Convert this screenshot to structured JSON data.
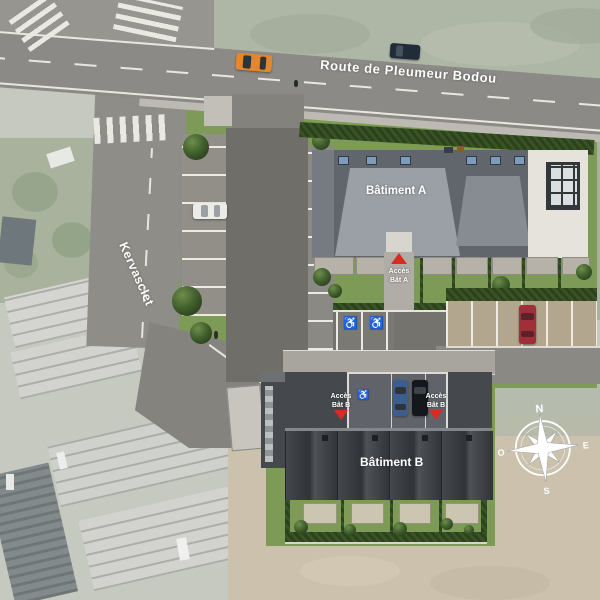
{
  "labels": {
    "route": "Route de Pleumeur Bodou",
    "street": "Kervasclet",
    "building_a": "Bâtiment A",
    "building_b": "Bâtiment B"
  },
  "access": {
    "a": {
      "line1": "Accès",
      "line2": "Bât A"
    },
    "b1": {
      "line1": "Accès",
      "line2": "Bât B"
    },
    "b2": {
      "line1": "Accès",
      "line2": "Bât B"
    }
  },
  "compass": {
    "north": "N",
    "east": "E",
    "south": "S",
    "west": "O"
  },
  "icons": {
    "accessible_parking": "♿"
  },
  "colors": {
    "road": "#8b8a86",
    "site_asphalt": "#6f6e69",
    "marking_white": "#eceae3",
    "grass": "#7d9b56",
    "hedge": "#33491f",
    "roof_a_dark": "#61666c",
    "roof_a_light": "#9aa0a5",
    "roof_b": "#3a3e42",
    "flat_roof": "#e6e3dd",
    "field_tan": "#cbc1ad",
    "field_sage": "#aeb6a6",
    "aerial_muted": "#c6c9bf",
    "access_red": "#d92b1f"
  },
  "vehicles": [
    {
      "name": "car-orange-road",
      "color": "#e2862f"
    },
    {
      "name": "car-navy-road",
      "color": "#222c38"
    },
    {
      "name": "car-white-parking",
      "color": "#ebebe8"
    },
    {
      "name": "car-blue-carport",
      "color": "#3c5d8f"
    },
    {
      "name": "car-black-carport",
      "color": "#14171b"
    },
    {
      "name": "car-red-parking",
      "color": "#a12f3a"
    }
  ]
}
